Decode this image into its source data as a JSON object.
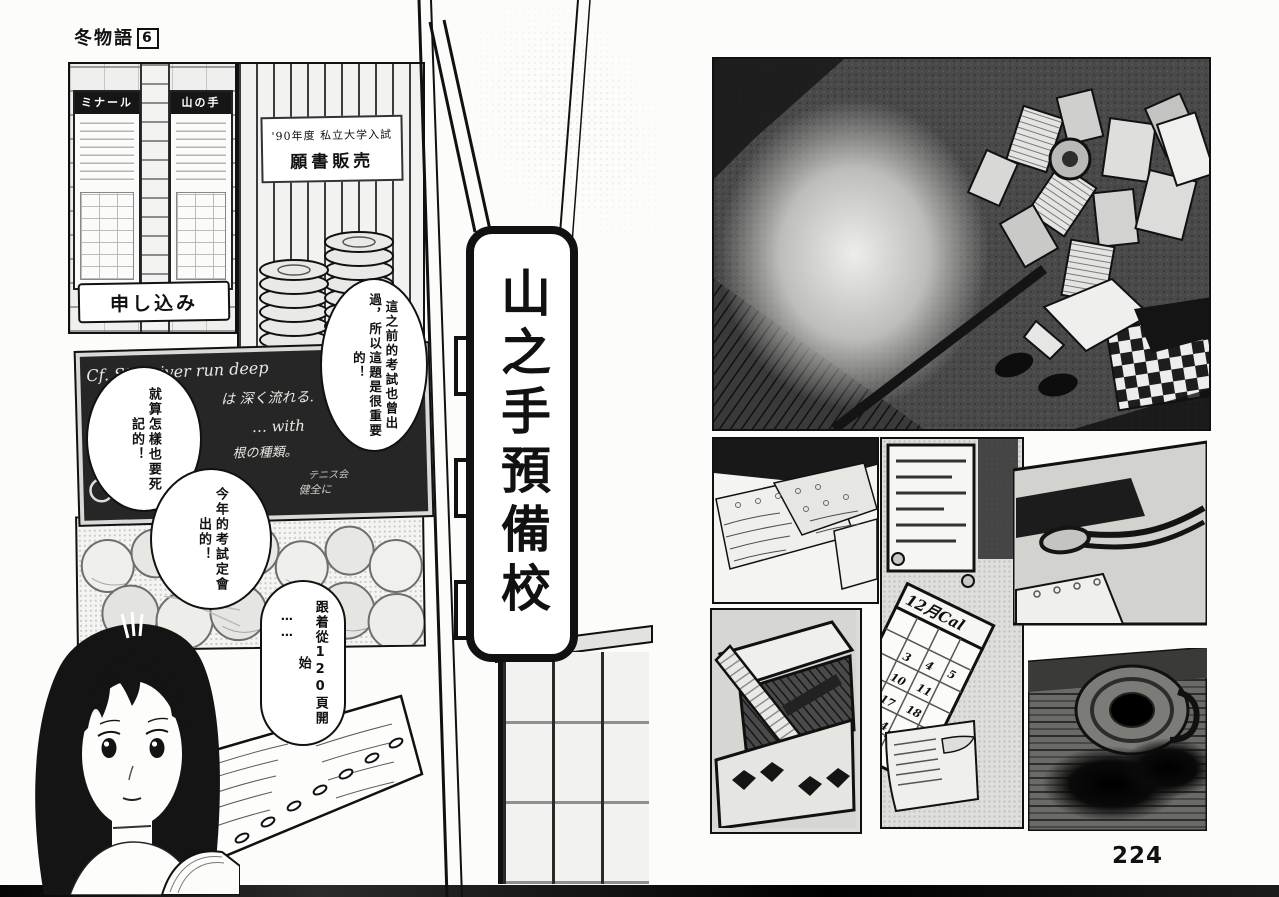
{
  "page": {
    "series_title": "冬物語",
    "volume_number": "6",
    "page_number": "224"
  },
  "left_page": {
    "poster_wall": {
      "left_poster_header": "ミナール",
      "right_poster_header": "山の手",
      "bottom_banner": "申し込み"
    },
    "application_sign": {
      "line1": "'90年度 私立大学入試",
      "line2": "願書販売"
    },
    "blackboard": {
      "chalk_line1": "Cf. Still river run deep",
      "chalk_line2": "は 深く流れる.",
      "chalk_line3": "… with",
      "chalk_line4": "根の種類。",
      "chalk_line5": "テニス会",
      "chalk_line6": "健全に"
    },
    "bubbles": {
      "bubble1": "這之前的考試也曾出過，所以這題是很重要的！",
      "bubble2": "就算怎樣也要死記的！",
      "bubble3": "今年的考試定會出的！",
      "bubble4_leadin": "⋯⋯",
      "bubble4": "跟着從120頁開始"
    }
  },
  "signboard": {
    "text": "山之手預備校"
  },
  "right_page": {
    "calendar": {
      "header": "12月Cal",
      "days": [
        "3",
        "4",
        "5",
        "10",
        "11",
        "17",
        "18",
        "24",
        "25"
      ]
    }
  }
}
